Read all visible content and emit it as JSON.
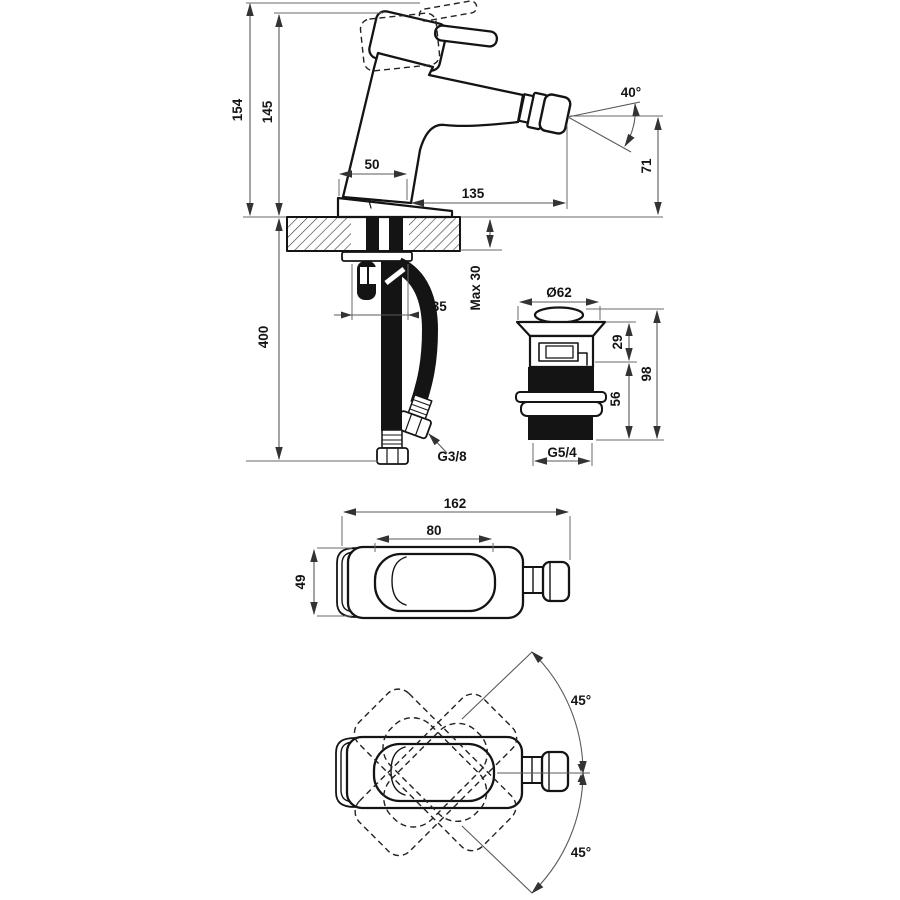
{
  "drawing": {
    "type": "technical-dimension-drawing",
    "subject": "single-lever bidet mixer with pop-up waste",
    "colors": {
      "outline": "#141414",
      "dimension": "#5a5a5a",
      "background": "#ffffff"
    },
    "side_view": {
      "overall_height": "154",
      "body_height": "145",
      "hose_length": "400",
      "body_width": "50",
      "spout_reach": "135",
      "aerator_angle": "40°",
      "spout_height": "71",
      "deck_thickness": "Max 30",
      "hole_diameter": "Ø35",
      "hose_thread": "G3/8"
    },
    "drain_view": {
      "cap_diameter": "Ø62",
      "cap_height": "29",
      "total_height": "98",
      "thread_length": "56",
      "waste_thread": "G5/4"
    },
    "top_view": {
      "overall_length": "162",
      "handle_length": "80",
      "body_width": "49"
    },
    "swivel_view": {
      "swivel_up": "45°",
      "swivel_down": "45°"
    }
  }
}
